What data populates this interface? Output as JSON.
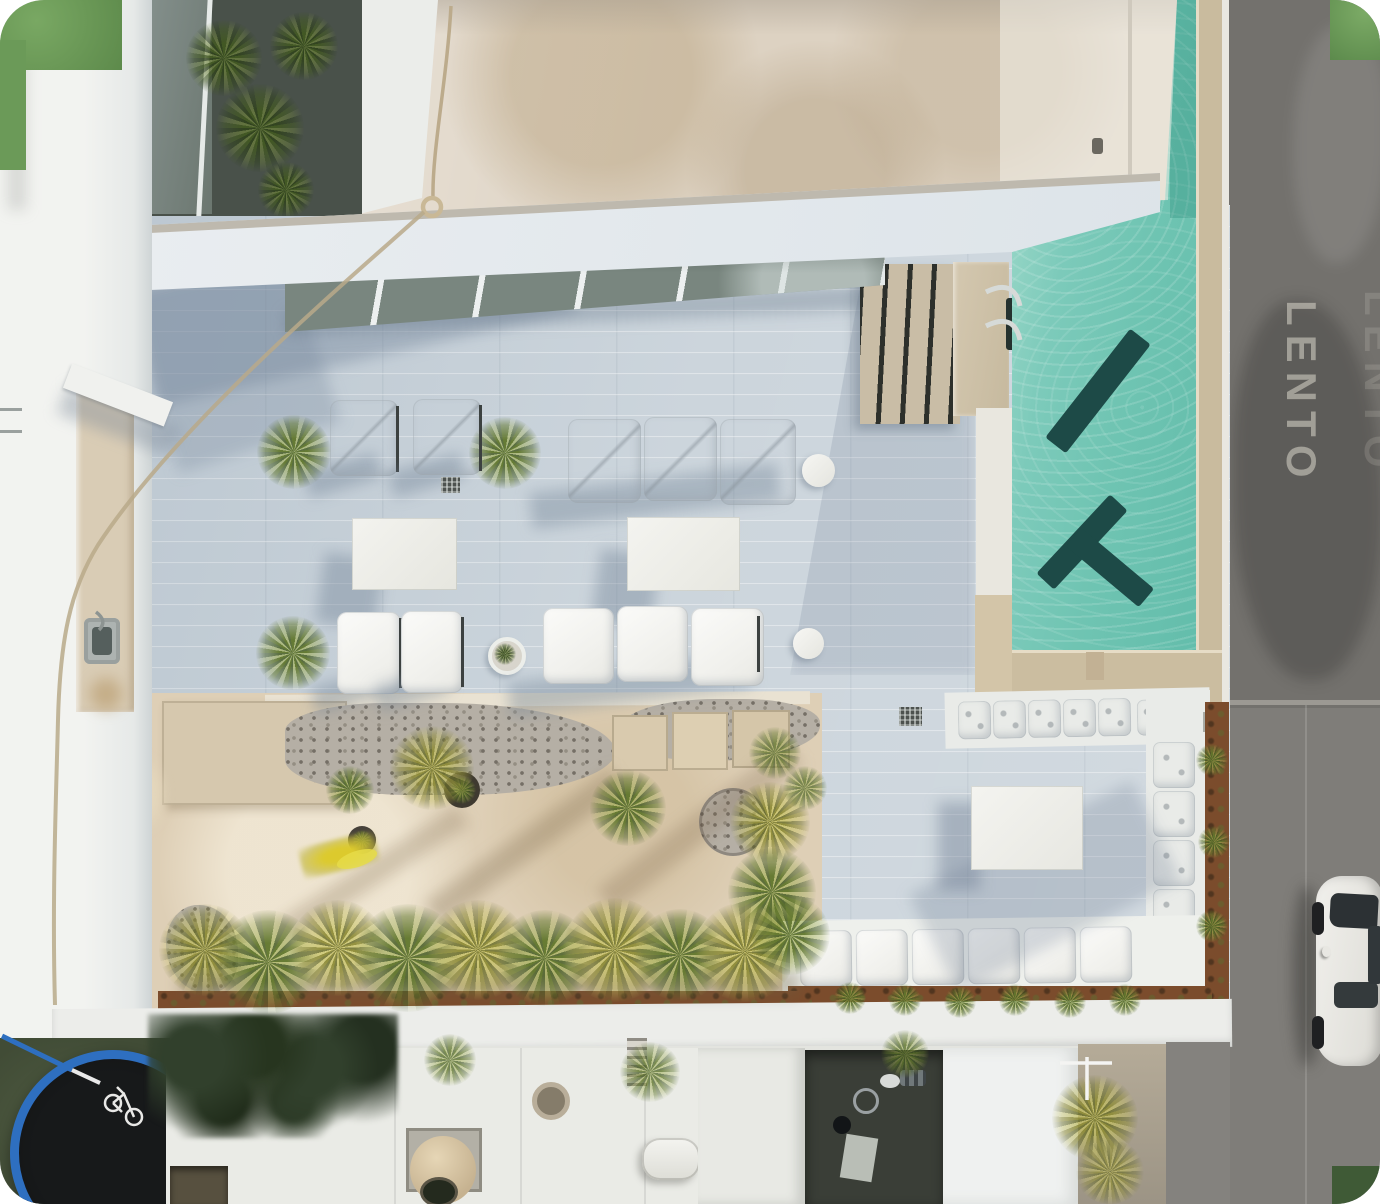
{
  "scene": {
    "description": "Aerial drone photo: white rooftop terrace with turquoise pool, lounge furniture, desert garden, street with parked car",
    "road_marking": "LENTO"
  },
  "colors": {
    "terrace_tile": "#c6d0d8",
    "pool_water": "#6fc4b2",
    "pool_water_light": "#a5dccd",
    "pool_shape": "#1d4a47",
    "coping_tan": "#c9bb9e",
    "roof_beige": "#ddd2c2",
    "sand": "#decfb6",
    "street": "#7f7d79",
    "rust_planter": "#7b4c2c",
    "palm_green": "#8a9a4a",
    "grass": "#4b563e",
    "trampoline_rim": "#2e6fc0",
    "cushion_white": "#eef0f1",
    "skylight_glass": "#79867f"
  }
}
